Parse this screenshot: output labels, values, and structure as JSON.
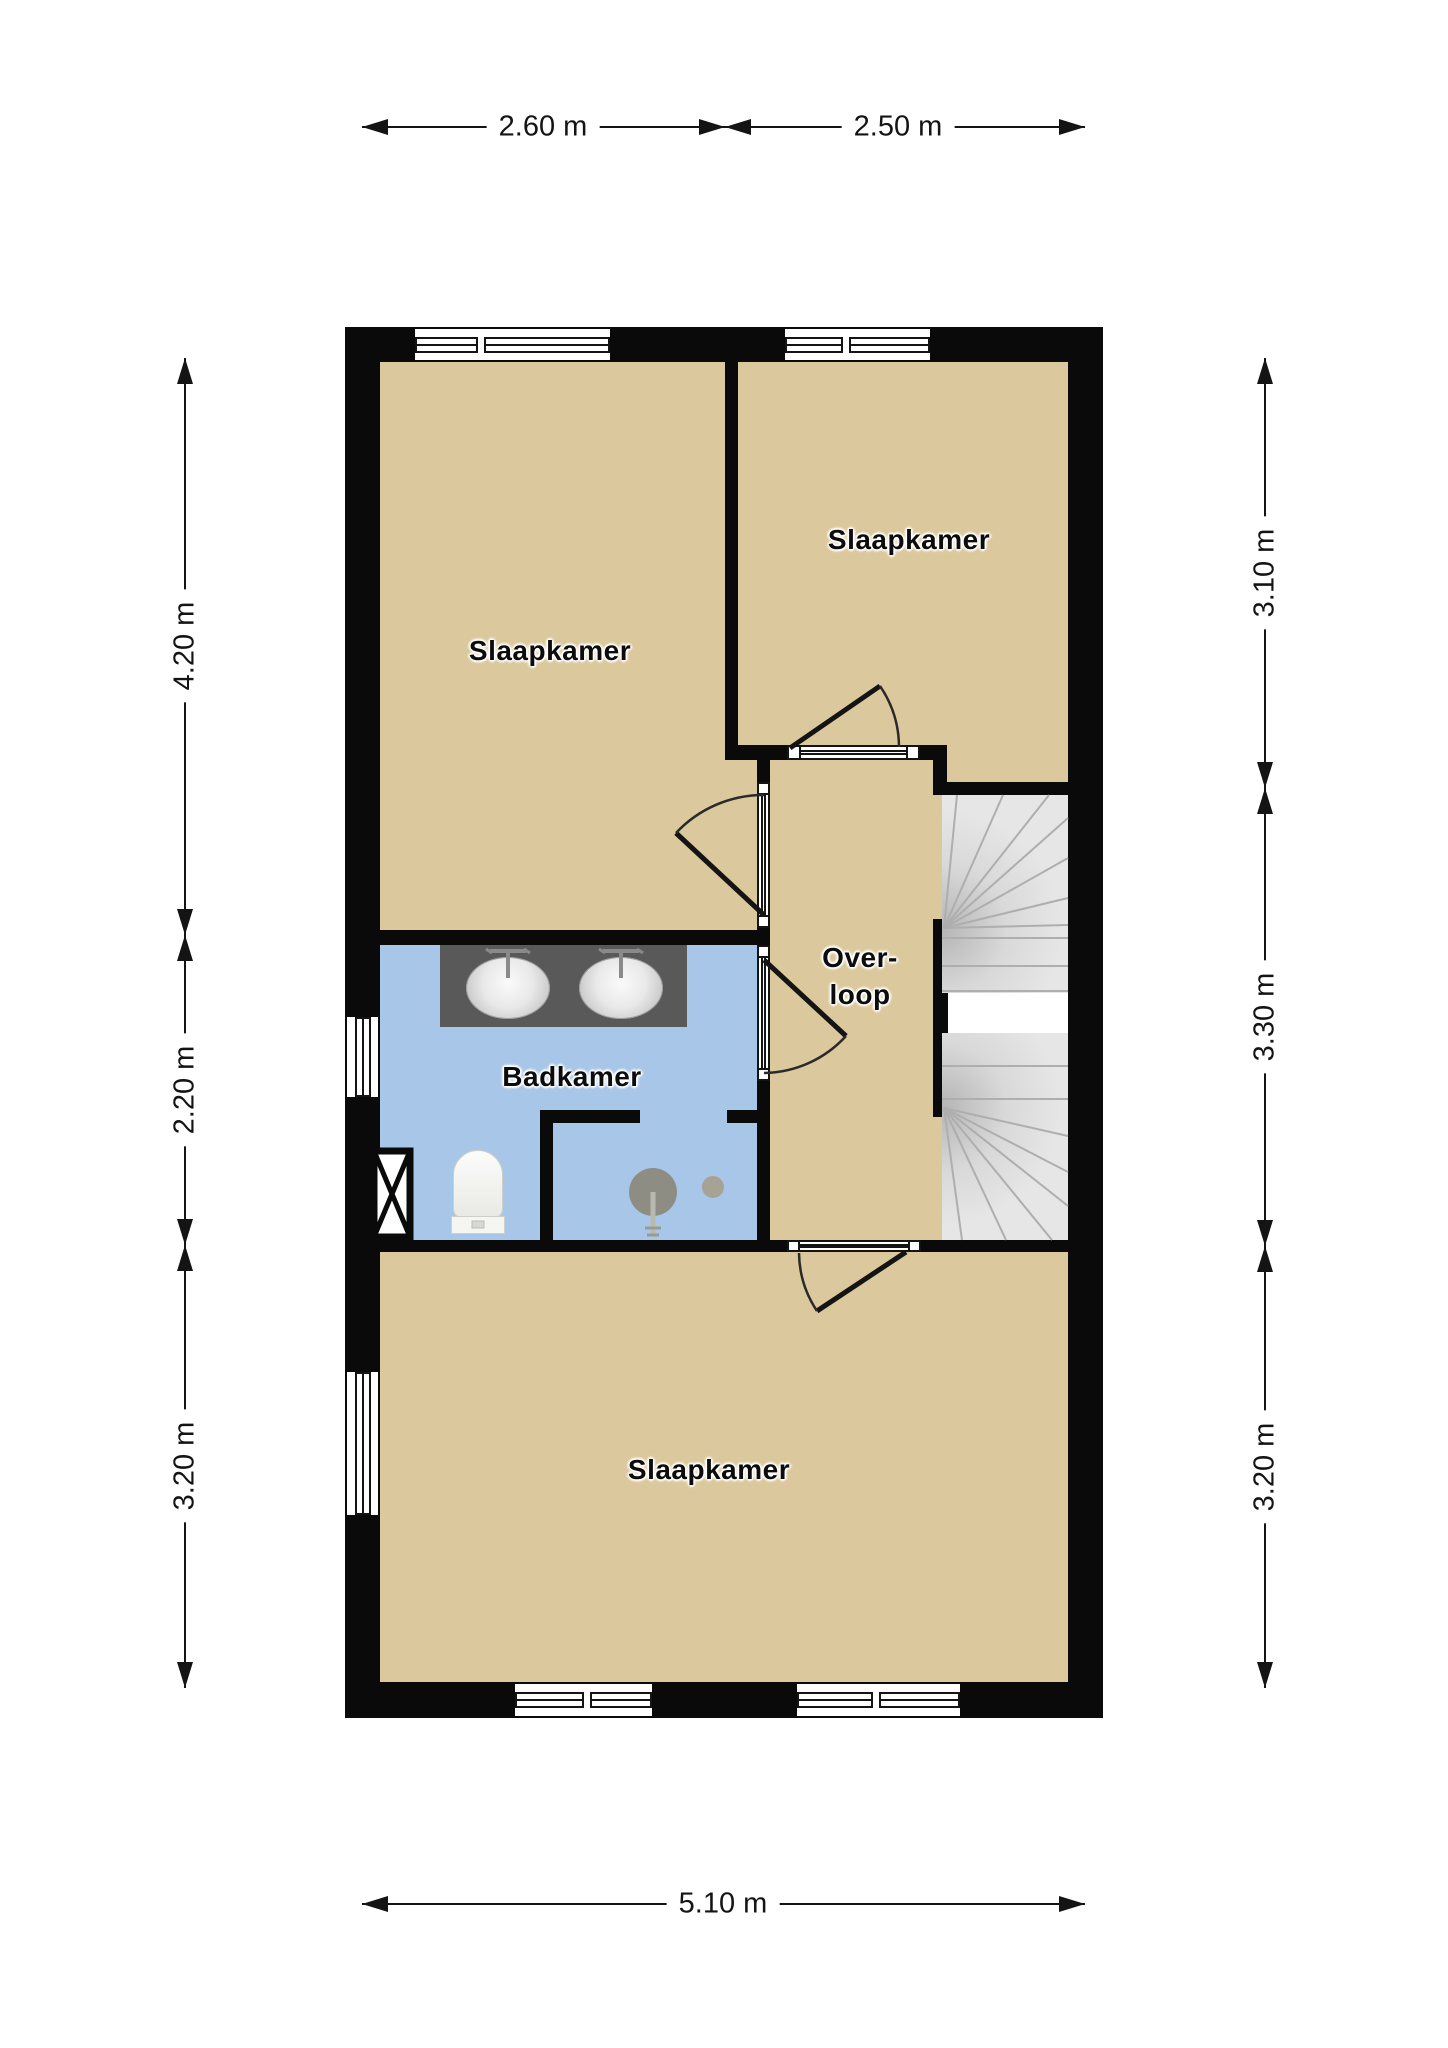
{
  "title": "floor-plan-verdieping",
  "rooms": [
    {
      "name": "slaapkamer-top-left",
      "label": "Slaapkamer"
    },
    {
      "name": "slaapkamer-top-right",
      "label": "Slaapkamer"
    },
    {
      "name": "badkamer",
      "label": "Badkamer"
    },
    {
      "name": "overloop",
      "label_line1": "Over-",
      "label_line2": "loop"
    },
    {
      "name": "slaapkamer-bottom",
      "label": "Slaapkamer"
    }
  ],
  "dimensions": {
    "top": [
      {
        "label": "2.60 m"
      },
      {
        "label": "2.50 m"
      }
    ],
    "bottom": [
      {
        "label": "5.10 m"
      }
    ],
    "left": [
      {
        "label": "4.20 m"
      },
      {
        "label": "2.20 m"
      },
      {
        "label": "3.20 m"
      }
    ],
    "right": [
      {
        "label": "3.10 m"
      },
      {
        "label": "3.30 m"
      },
      {
        "label": "3.20 m"
      }
    ]
  },
  "fixtures": [
    "double-sink-vanity",
    "toilet",
    "shower",
    "ventilation-shaft",
    "winder-staircase"
  ],
  "colors": {
    "wall": "#0a0a0a",
    "room_fill": "#dbc89c",
    "bathroom_fill": "#a8c6e8",
    "stair_fill": "#e3e3e3",
    "label_text": "#0c0c0c",
    "dimension_text": "#141414"
  }
}
